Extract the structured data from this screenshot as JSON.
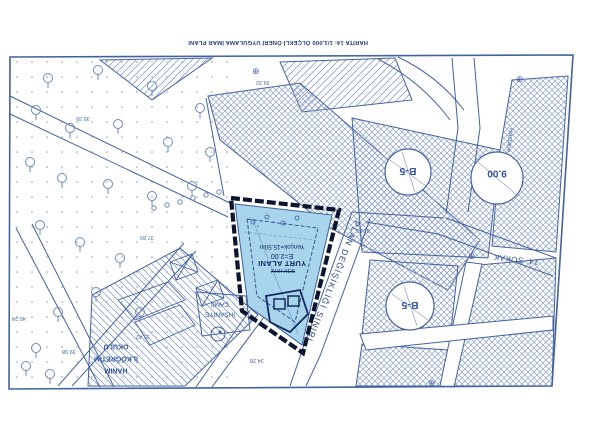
{
  "map": {
    "title": "HARİTA 14: 1/1.000 ÖLÇEKLİ ÖNERİ UYGULAMA İMAR PLANI",
    "parcel": {
      "designation": "YURT ALANI",
      "emsal": "E=2.00",
      "yencok": "Yençok=15.50m",
      "struck_label": "XHH XES"
    },
    "boundary_label": "PLAN DEĞİŞİKLİĞİ SINIRI",
    "zones": {
      "b5_upper": "B-5",
      "b5_lower": "B-5",
      "road_width": "9.00"
    },
    "streets": {
      "sokak_14": "14. SOKAK",
      "hastane": "Hastane"
    },
    "landmarks": {
      "school": {
        "line1": "HANIM",
        "line2": "İLKÖĞRETİM",
        "line3": "OKULU"
      },
      "mosque": {
        "line1": "İHSANİYE",
        "line2": "CAMİİ"
      }
    },
    "elevations": [
      "39.35",
      "39.32",
      "31.85",
      "37.89",
      "35.42",
      "34.28",
      "40.24",
      "39.98"
    ],
    "symbols": {
      "benchmark": "⊕"
    },
    "colors": {
      "ink": "#43629f",
      "ink_dark": "#1d3a7c",
      "boundary": "#0c1630",
      "parcel_fill": "#a8d4ec",
      "hatch": "#8aa0c8",
      "paper": "#ffffff"
    }
  }
}
